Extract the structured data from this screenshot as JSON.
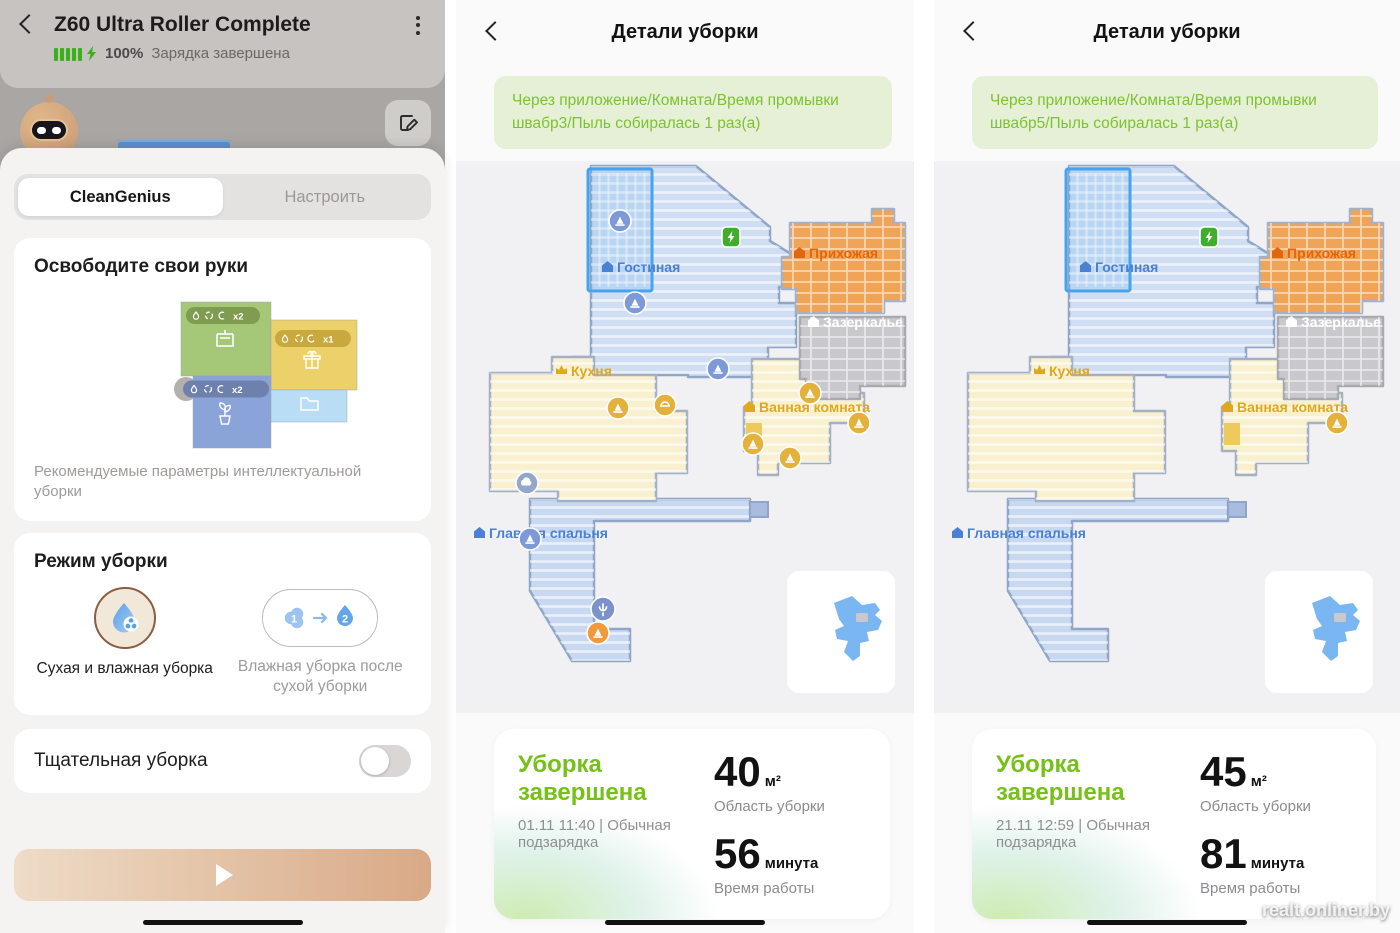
{
  "left_panel": {
    "header": {
      "title": "Z60 Ultra Roller Complete",
      "battery": "100%",
      "status": "Зарядка завершена"
    },
    "tabs": {
      "active": "CleanGenius",
      "inactive": "Настроить"
    },
    "hands_free": {
      "title": "Освободите свои руки",
      "caption": "Рекомендуемые параметры интеллектуальной уборки",
      "badge_green": "x2",
      "badge_yellow": "x1",
      "badge_blue": "x2"
    },
    "mode": {
      "title": "Режим уборки",
      "option1": "Сухая и влажная уборка",
      "option2": "Влажная уборка после сухой уборки",
      "step1": "1",
      "step2": "2"
    },
    "thorough": {
      "label": "Тщательная уборка"
    }
  },
  "panels": [
    {
      "title": "Детали уборки",
      "banner": "Через приложение/Комната/Время промывки швабр3/Пыль собиралась 1 раз(а)",
      "status": "Уборка завершена",
      "datetime": "01.11  11:40 | Обычная подзарядка",
      "area": "40",
      "area_unit": "м²",
      "area_label": "Область уборки",
      "time": "56",
      "time_unit": "минута",
      "time_label": "Время работы"
    },
    {
      "title": "Детали уборки",
      "banner": "Через приложение/Комната/Время промывки швабр5/Пыль собиралась 1 раз(а)",
      "status": "Уборка завершена",
      "datetime": "21.11  12:59 | Обычная подзарядка",
      "area": "45",
      "area_unit": "м²",
      "area_label": "Область уборки",
      "time": "81",
      "time_unit": "минута",
      "time_label": "Время работы"
    }
  ],
  "map": {
    "rooms": [
      {
        "name": "Гостиная"
      },
      {
        "name": "Прихожая"
      },
      {
        "name": "Зазеркалье"
      },
      {
        "name": "Кухня"
      },
      {
        "name": "Ванная комната"
      },
      {
        "name": "Главная спальня"
      }
    ]
  },
  "watermark": "realt.onliner.by",
  "colors": {
    "accent_green": "#7cc132",
    "banner_bg": "#e5f0d6",
    "battery_green": "#3cb019",
    "map_blue": "#cfdef2",
    "map_yellow": "#f9f0cf",
    "map_orange": "#f0a458",
    "map_gray": "#c9c9cd",
    "zone_stroke": "#45a3f0",
    "play_gradient_start": "#eedcc7",
    "play_gradient_end": "#d9a986"
  }
}
